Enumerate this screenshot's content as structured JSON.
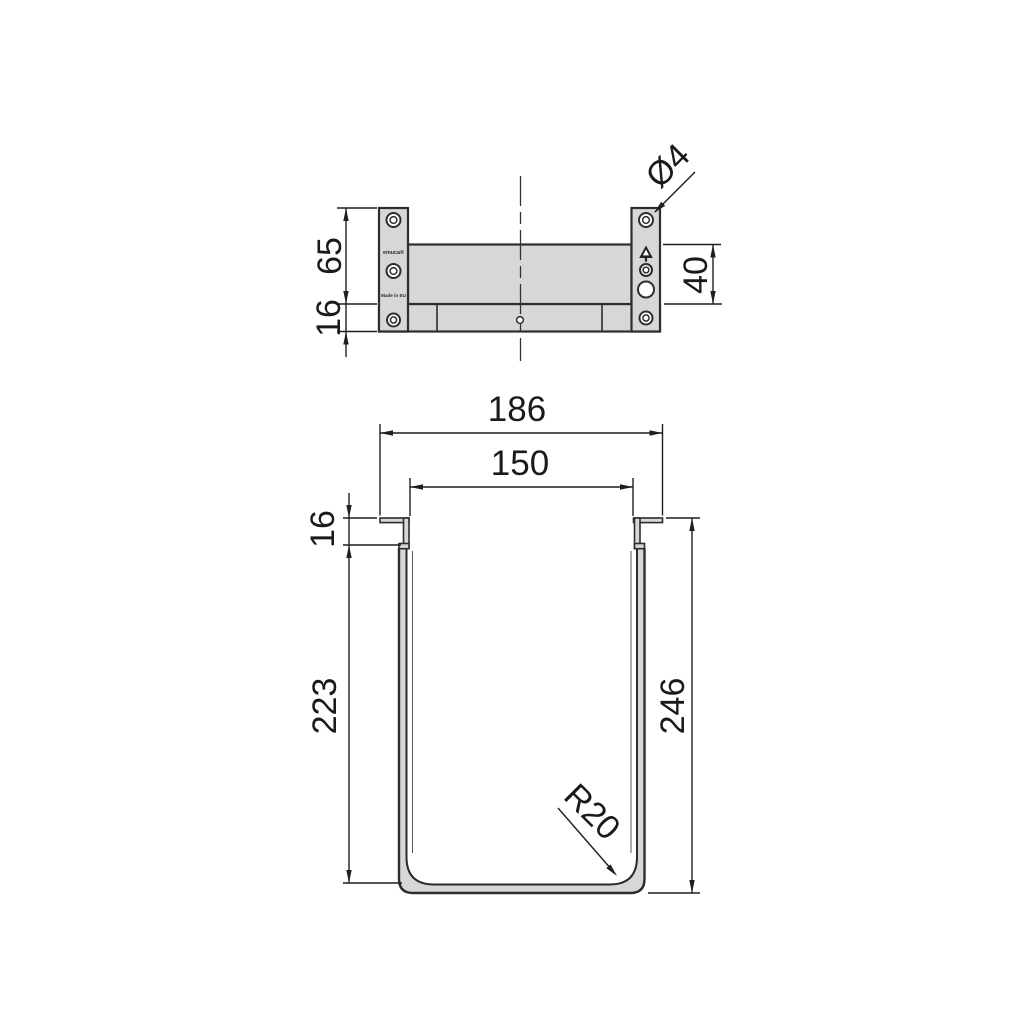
{
  "page": {
    "background": "#ffffff"
  },
  "drawing": {
    "colors": {
      "part_fill": "#d7d7d7",
      "outline": "#2d2d2d",
      "dimension_line": "#1f1f1f",
      "text": "#1a1a1a"
    },
    "icons": {
      "recycle": "recycle-triangle-icon"
    },
    "top_view": {
      "dim_side_height": "65",
      "dim_base_thickness": "16",
      "dim_back_panel_height": "40",
      "dim_hole_diameter": "Ø4",
      "brand_label": "emuca®",
      "origin_label": "Made in EU"
    },
    "front_view": {
      "dim_outer_width": "186",
      "dim_inner_width": "150",
      "dim_flange_height": "16",
      "dim_inner_depth": "223",
      "dim_outer_height": "246",
      "dim_corner_radius": "R20"
    }
  }
}
